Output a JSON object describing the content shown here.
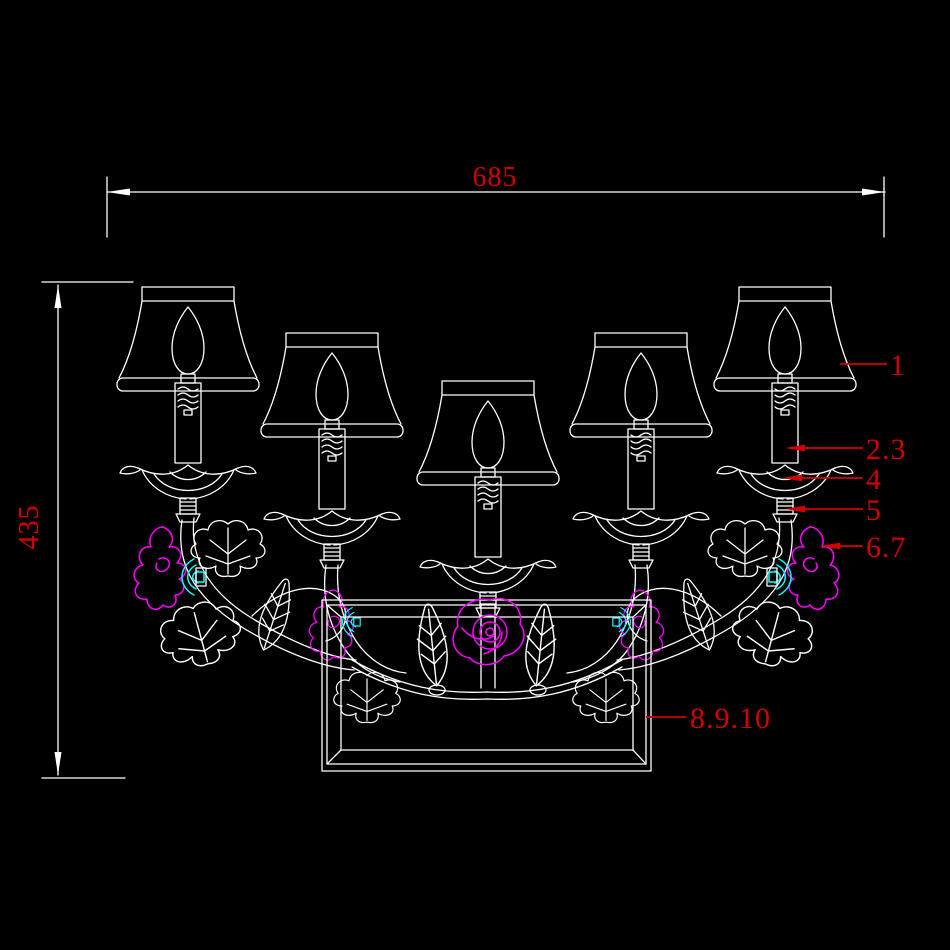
{
  "drawing": {
    "title": "wall-sconce-cad-drawing",
    "colors": {
      "background": "#000000",
      "line": "#ffffff",
      "dimension": "#d40000",
      "flower": "#ff00ff",
      "accent": "#00ffff"
    },
    "dimensions": {
      "width": "685",
      "height": "435"
    },
    "callouts": [
      {
        "label": "1"
      },
      {
        "label": "2.3"
      },
      {
        "label": "4"
      },
      {
        "label": "5"
      },
      {
        "label": "6.7"
      },
      {
        "label": "8.9.10"
      }
    ]
  }
}
